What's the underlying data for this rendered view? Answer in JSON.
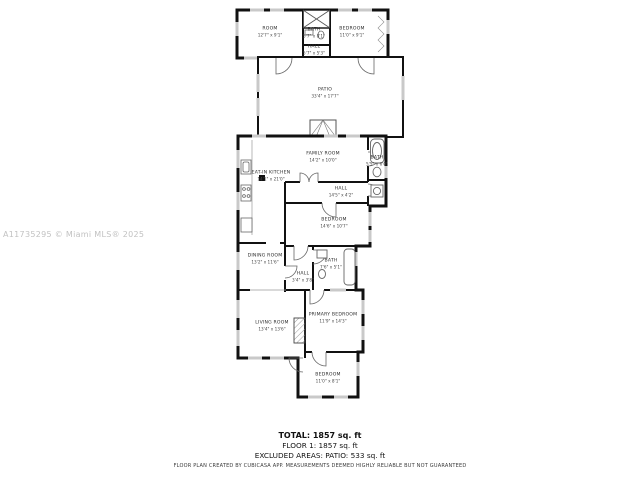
{
  "watermark": "A11735295 © Miami MLS® 2025",
  "rooms": [
    {
      "name": "ROOM",
      "dims": "12'7\" x 9'1\""
    },
    {
      "name": "BATH",
      "dims": "5'7\" x 8'1\""
    },
    {
      "name": "HALL",
      "dims": "5'7\" x 5'3\""
    },
    {
      "name": "BEDROOM",
      "dims": "11'0\" x 9'1\""
    },
    {
      "name": "PATIO",
      "dims": "33'4\" x 17'7\""
    },
    {
      "name": "FAMILY ROOM",
      "dims": "14'2\" x 10'0\""
    },
    {
      "name": "EAT-IN KITCHEN",
      "dims": "14'1\" x 21'0\""
    },
    {
      "name": "BATH",
      "dims": "5'5\" x 6'0\""
    },
    {
      "name": "HALL",
      "dims": "14'5\" x 4'2\""
    },
    {
      "name": "BEDROOM",
      "dims": "14'6\" x 10'7\""
    },
    {
      "name": "DINING ROOM",
      "dims": "13'2\" x 11'6\""
    },
    {
      "name": "BATH",
      "dims": "7'6\" x 5'1\""
    },
    {
      "name": "HALL",
      "dims": "3'4\" x 3'8\""
    },
    {
      "name": "LIVING ROOM",
      "dims": "13'4\" x 13'6\""
    },
    {
      "name": "PRIMARY BEDROOM",
      "dims": "11'9\" x 14'3\""
    },
    {
      "name": "BEDROOM",
      "dims": "11'0\" x 8'1\""
    }
  ],
  "summary": {
    "total": "TOTAL: 1857 sq. ft",
    "floor1": "FLOOR 1: 1857 sq. ft",
    "excluded": "EXCLUDED AREAS: PATIO: 533 sq. ft"
  },
  "footer": "FLOOR PLAN CREATED BY CUBICASA APP. MEASUREMENTS DEEMED HIGHLY RELIABLE BUT NOT GUARANTEED",
  "colors": {
    "wall": "#111111",
    "window": "#c9c9c9",
    "fixture": "#666666",
    "watermark": "#c2c2c2"
  }
}
